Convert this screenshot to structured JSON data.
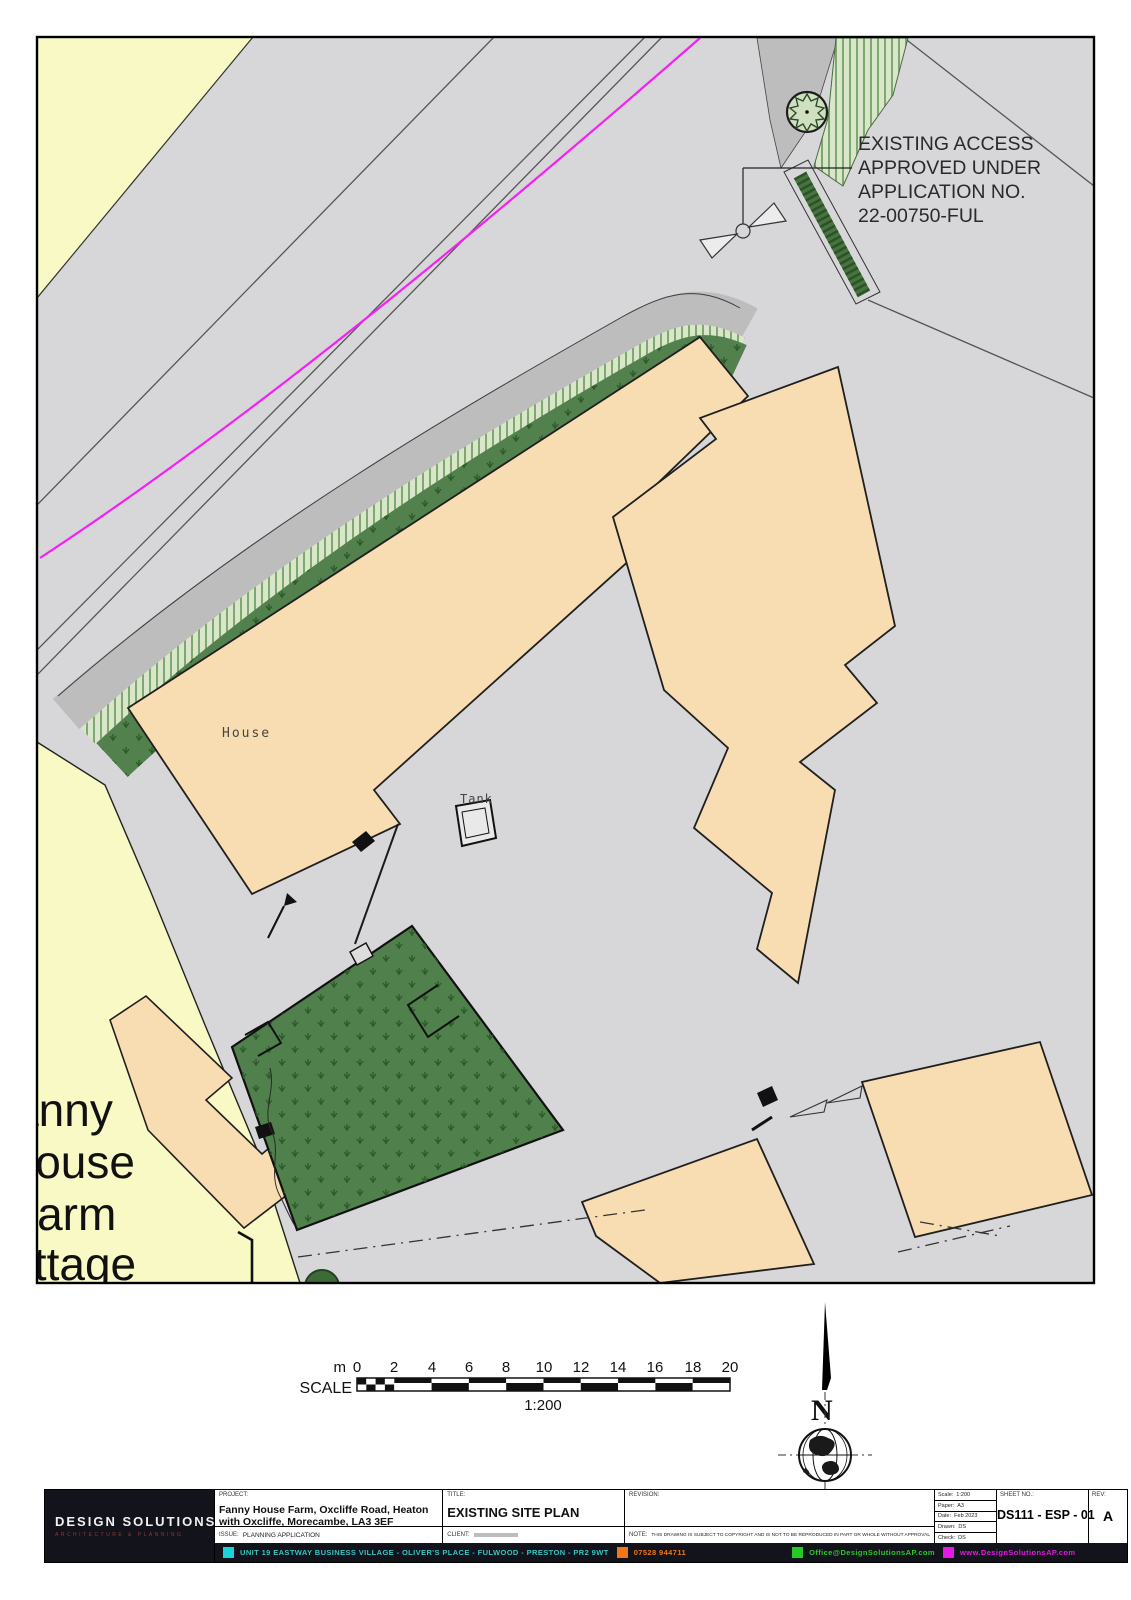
{
  "annotation": {
    "line1": "EXISTING ACCESS",
    "line2": "APPROVED UNDER",
    "line3": "APPLICATION NO.",
    "line4": "22-00750-FUL"
  },
  "labels": {
    "house": "House",
    "tank": "Tank",
    "cottage_line1": "Fanny",
    "cottage_line2": "House",
    "cottage_line3": "Farm",
    "cottage_line4": "Cottage"
  },
  "scale_bar": {
    "label": "SCALE",
    "unit": "m",
    "ticks": [
      "0",
      "2",
      "4",
      "6",
      "8",
      "10",
      "12",
      "14",
      "16",
      "18",
      "20"
    ],
    "ratio": "1:200"
  },
  "north": {
    "letter": "N"
  },
  "titleblock": {
    "project_label": "PROJECT:",
    "project": "Fanny House Farm, Oxcliffe Road, Heaton with Oxcliffe, Morecambe, LA3 3EF",
    "title_label": "TITLE:",
    "title": "EXISTING SITE PLAN",
    "revision_label": "REVISION:",
    "issue_label": "ISSUE:",
    "issue": "PLANNING APPLICATION",
    "client_label": "CLIENT:",
    "note_label": "NOTE:",
    "note": "THIS DRAWING IS SUBJECT TO COPYRIGHT AND IS NOT TO BE REPRODUCED IN PART OR WHOLE WITHOUT APPROVAL",
    "fields": {
      "scale_label": "Scale:",
      "scale": "1:200",
      "paper_label": "Paper:",
      "paper": "A3",
      "date_label": "Date:",
      "date": "Feb 2023",
      "drawn_label": "Drawn:",
      "drawn": "DS",
      "check_label": "Check:",
      "check": "DS"
    },
    "sheet_label": "SHEET NO.:",
    "sheet": "DS111 - ESP - 01",
    "rev_label": "REV:",
    "rev": "A"
  },
  "brand": {
    "name": "DESIGN SOLUTIONS",
    "tagline": "ARCHITECTURE & PLANNING"
  },
  "contacts": {
    "address": "UNIT 19 EASTWAY BUSINESS VILLAGE - OLIVER'S PLACE - FULWOOD - PRESTON - PR2 9WT",
    "phone": "07528 944711",
    "email": "Office@DesignSolutionsAP.com",
    "web": "www.DesignSolutionsAP.com"
  },
  "colors": {
    "boundary_magenta": "#f520f5",
    "grass_green": "#53814d",
    "building_peach": "#f9ddb2",
    "parcel_yellow": "#f9f9c5",
    "road_grey": "#d7d7d9",
    "pavement_grey": "#bdbdbd",
    "accent_cyan": "#19d2dc",
    "accent_orange": "#f07818",
    "accent_green": "#28c828",
    "accent_magenta": "#e618e6"
  }
}
